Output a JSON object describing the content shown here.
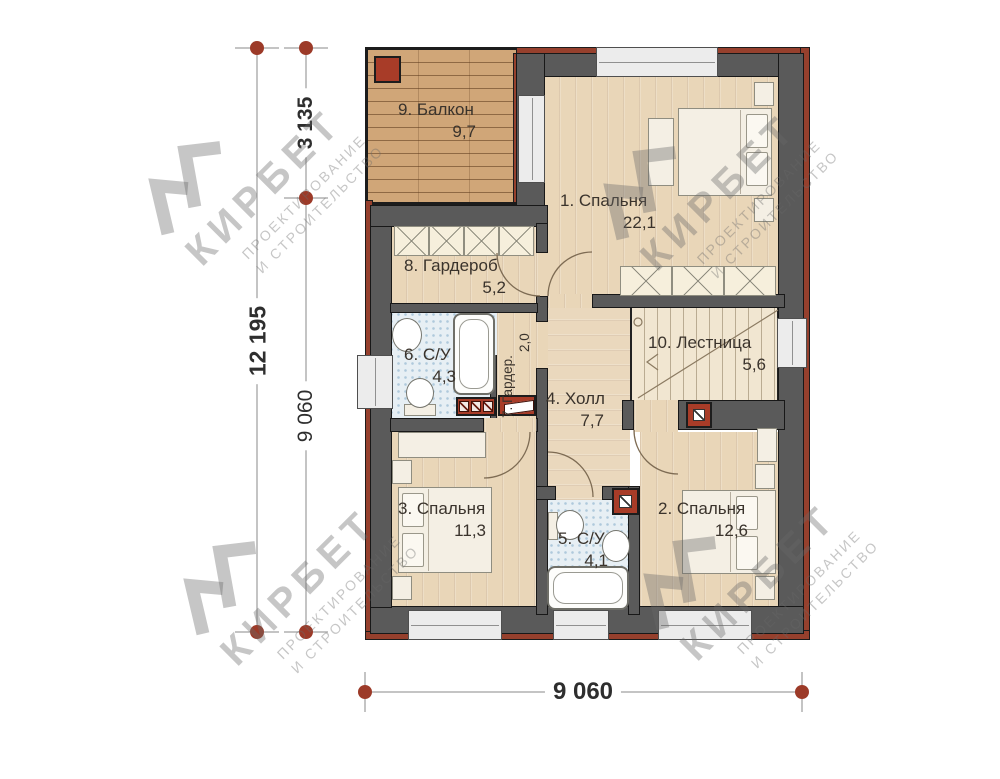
{
  "rooms": [
    {
      "label": "1. Спальня",
      "area": "22,1"
    },
    {
      "label": "2. Спальня",
      "area": "12,6"
    },
    {
      "label": "3. Спальня",
      "area": "11,3"
    },
    {
      "label": "4. Холл",
      "area": "7,7"
    },
    {
      "label": "5. С/У",
      "area": "4,1"
    },
    {
      "label": "6. С/У",
      "area": "4,3"
    },
    {
      "label": "7. Гардер.",
      "area": "2,0"
    },
    {
      "label": "8. Гардероб",
      "area": "5,2"
    },
    {
      "label": "9. Балкон",
      "area": "9,7"
    },
    {
      "label": "10. Лестница",
      "area": "5,6"
    }
  ],
  "dimensions": {
    "height_total": "12 195",
    "height_top": "3 135",
    "height_main": "9 060",
    "width_bottom": "9 060"
  },
  "watermark": {
    "brand": "КИРБЕТ",
    "line1": "ПРОЕКТИРОВАНИЕ",
    "line2": "И СТРОИТЕЛЬСТВО"
  },
  "colors": {
    "wall": "#5a5a5a",
    "brick": "#96402d",
    "brick2": "#a83c28",
    "wood": "#e9d6b8",
    "wood2": "#ead8bd",
    "deck": "#d0a678",
    "tile": "#e7eff4",
    "marker": "#9c3a28"
  }
}
